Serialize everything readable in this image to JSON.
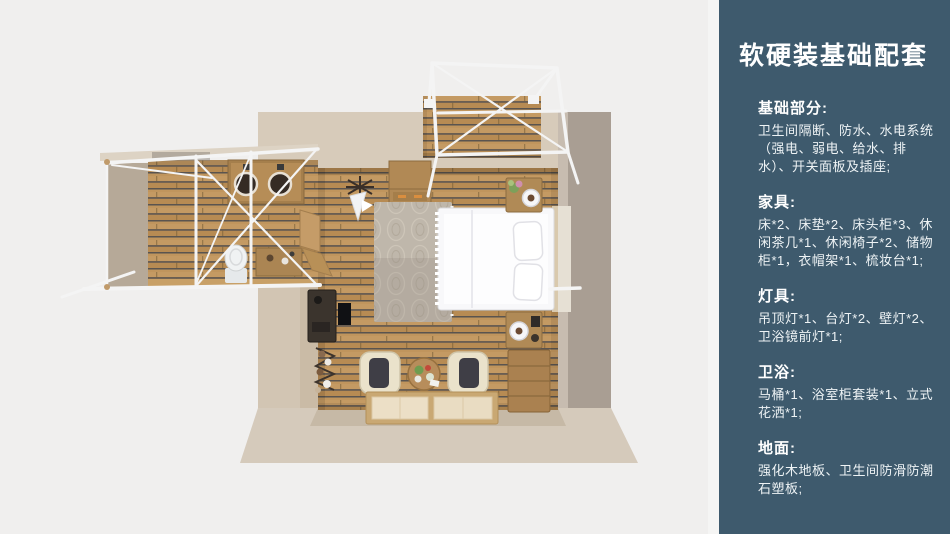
{
  "panel": {
    "title": "软硬装基础配套",
    "sections": [
      {
        "title": "基础部分:",
        "body": "卫生间隔断、防水、水电系统（强电、弱电、给水、排水）、开关面板及插座;"
      },
      {
        "title": "家具:",
        "body": "床*2、床垫*2、床头柜*3、休闲茶几*1、休闲椅子*2、储物柜*1，衣帽架*1、梳妆台*1;"
      },
      {
        "title": "灯具:",
        "body": "吊顶灯*1、台灯*2、壁灯*2、卫浴镜前灯*1;"
      },
      {
        "title": "卫浴:",
        "body": "马桶*1、浴室柜套装*1、立式花洒*1;"
      },
      {
        "title": "地面:",
        "body": "强化木地板、卫生间防滑防潮石塑板;"
      }
    ]
  },
  "colors": {
    "canvas_bg": "#f0efee",
    "panel_bg": "#3e5a6d",
    "panel_text": "#eef3f5",
    "wall_beige": "#d7cbba",
    "wall_taupe": "#a99e93",
    "wood_plank": "#bc9158",
    "rug": "#bfb7ab",
    "bed_white": "#f8f8fa",
    "frame_white": "#f4f4f4"
  }
}
